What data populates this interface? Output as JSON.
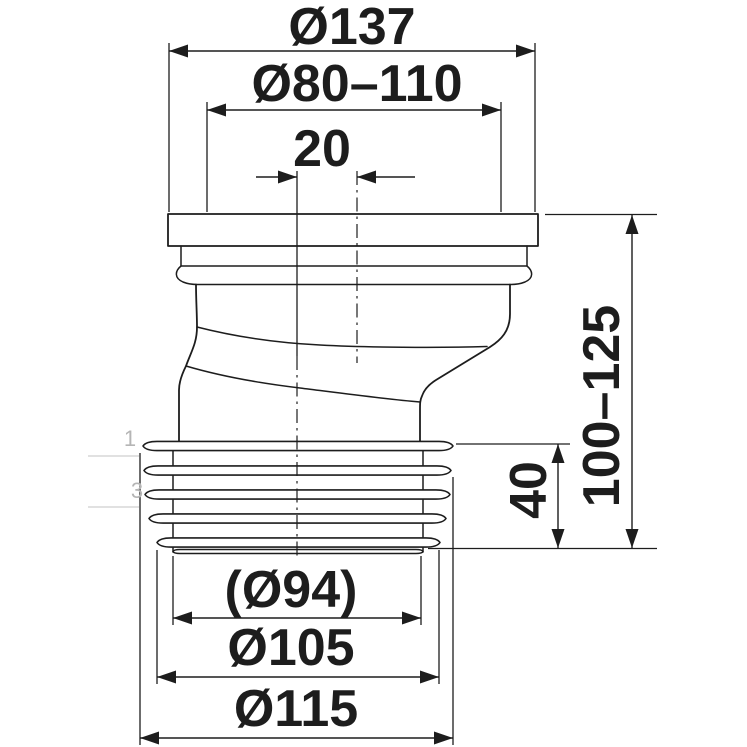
{
  "figure": {
    "kind": "technical dimensional drawing",
    "subject": "offset toilet pan connector (eccentric WC outlet connector), side view",
    "background": "#ffffff",
    "line_color": "#1d1d1d",
    "faint_color": "#b5b5b5"
  },
  "dims": {
    "flange_outer_diameter": "Ø137",
    "inlet_diameter_range": "Ø80–110",
    "offset": "20",
    "height_range": "100–125",
    "seal_height": "40",
    "outlet_bore_diameter": "(Ø94)",
    "outlet_mid_diameter": "Ø105",
    "outlet_max_diameter": "Ø115"
  },
  "margin_marks": {
    "top": "1",
    "bottom": "3"
  }
}
